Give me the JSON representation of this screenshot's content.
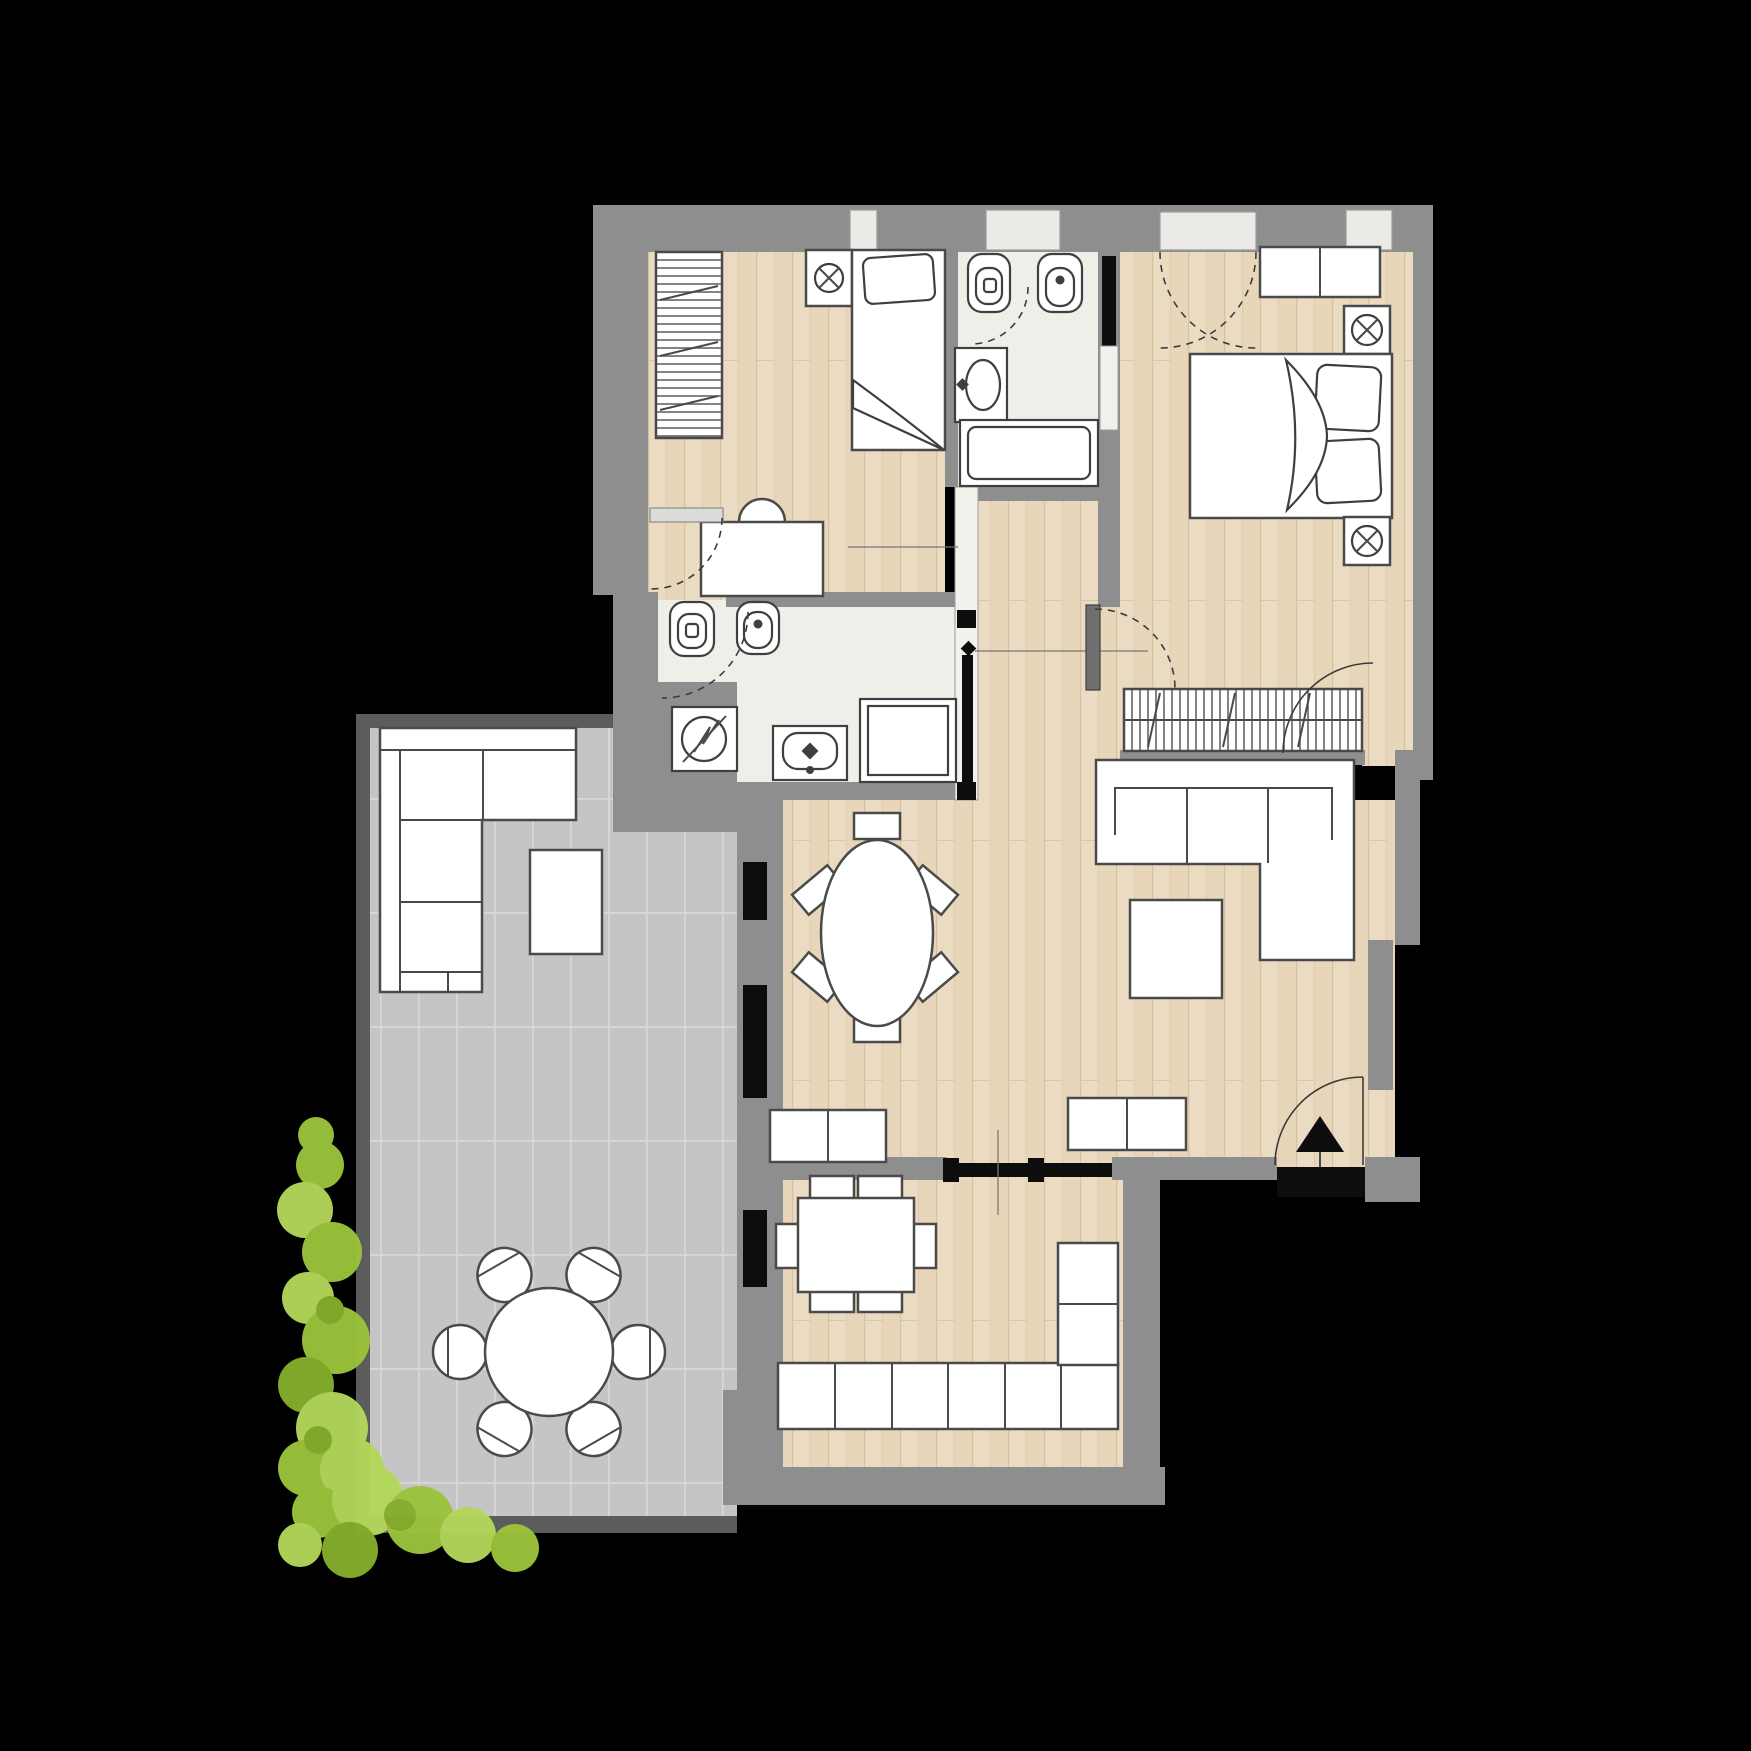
{
  "title": "apartment-floor-plan",
  "colors": {
    "background": "#000000",
    "wall": "#8e8e8e",
    "wall_dark": "#5c5c5c",
    "wood_floor": "#eadbc2",
    "wood_floor_alt": "#e3d1b3",
    "bath_floor": "#efeee9",
    "terrace_tile": "#c5c5c5",
    "tile_grout": "#d8d8d8",
    "furniture_fill": "#ffffff",
    "furniture_stroke": "#4a4a4a",
    "glazing": "#0d0d0d",
    "plant_green": "#9cc43c",
    "plant_green_light": "#b4d75a",
    "plant_green_dark": "#85ae2c"
  },
  "rooms": [
    {
      "id": "bedroom-single",
      "furniture": [
        "wardrobe-hatched",
        "single-bed",
        "nightstand-with-lamp",
        "desk",
        "desk-chair"
      ]
    },
    {
      "id": "bathroom-top",
      "furniture": [
        "toilet",
        "bidet",
        "wall-sink",
        "bathtub"
      ],
      "doors": [
        "pocket-sliding-door"
      ]
    },
    {
      "id": "bedroom-master",
      "furniture": [
        "dresser",
        "double-bed",
        "nightstand-with-lamp",
        "nightstand-with-lamp",
        "wardrobe-hatched"
      ],
      "doors": [
        "pocket-sliding-door",
        "hinged-door"
      ]
    },
    {
      "id": "bathroom-inner",
      "furniture": [
        "toilet",
        "bidet",
        "washing-machine",
        "sink",
        "shower-tray"
      ]
    },
    {
      "id": "corridor",
      "doors": [
        "pocket-sliding-door"
      ]
    },
    {
      "id": "living-dining-room",
      "furniture": [
        "oval-dining-table",
        "six-chairs",
        "corner-sofa-with-chaise",
        "coffee-table",
        "sideboard",
        "sideboard"
      ],
      "doors": [
        "entrance-door",
        "sliding-door-to-kitchen"
      ]
    },
    {
      "id": "kitchen",
      "furniture": [
        "square-table",
        "six-chairs",
        "l-shaped-counter"
      ]
    },
    {
      "id": "terrace",
      "furniture": [
        "outdoor-corner-sofa",
        "side-table",
        "round-table",
        "six-round-chairs",
        "climbing-plant"
      ]
    }
  ],
  "symbols": [
    "ceiling-lamp-icon",
    "washing-machine-icon",
    "entrance-arrow-icon",
    "door-swing-arc",
    "window-casement-arc"
  ]
}
